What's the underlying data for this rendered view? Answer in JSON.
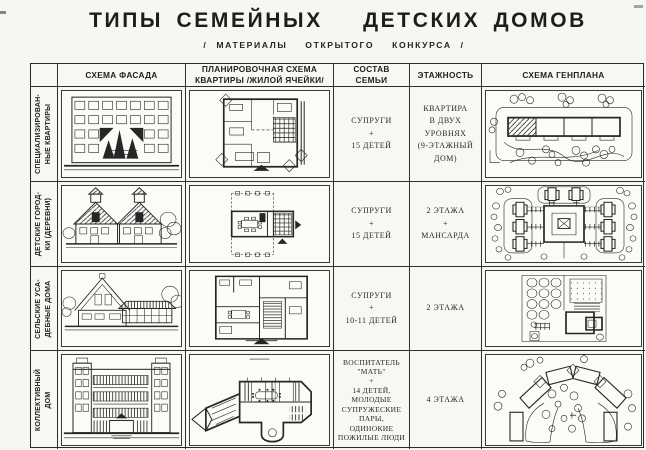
{
  "title": "ТИПЫ СЕМЕЙНЫХ   ДЕТСКИХ ДОМОВ",
  "subtitle": "/ МАТЕРИАЛЫ  ОТКРЫТОГО  КОНКУРСА /",
  "table": {
    "headers": {
      "facade": "СХЕМА ФАСАДА",
      "plan": "ПЛАНИРОВОЧНАЯ СХЕМА\nКВАРТИРЫ /ЖИЛОЙ ЯЧЕЙКИ/",
      "family": "СОСТАВ\nСЕМЬИ",
      "floors": "ЭТАЖНОСТЬ",
      "genplan": "СХЕМА  ГЕНПЛАНА"
    },
    "rows": [
      {
        "label": "СПЕЦИАЛИЗИРОВАН-\nНЫЕ КВАРТИРЫ",
        "family": "СУПРУГИ\n+\n15 ДЕТЕЙ",
        "floors": "КВАРТИРА\nВ ДВУХ\nУРОВНЯХ\n(9-ЭТАЖНЫЙ\nДОМ)"
      },
      {
        "label": "ДЕТСКИЕ ГОРОД-\nКИ (ДЕРЕВНИ)",
        "family": "СУПРУГИ\n+\n15 ДЕТЕЙ",
        "floors": "2 ЭТАЖА\n+\nМАНСАРДА"
      },
      {
        "label": "СЕЛЬСКИЕ УСА-\nДЕБНЫЕ ДОМА",
        "family": "СУПРУГИ\n+\n10-11 ДЕТЕЙ",
        "floors": "2 ЭТАЖА"
      },
      {
        "label": "КОЛЛЕКТИВНЫЙ\nДОМ",
        "family": "ВОСПИТАТЕЛЬ\n\"МАТЬ\"\n+\n14 ДЕТЕЙ,\nМОЛОДЫЕ\nСУПРУЖЕСКИЕ\nПАРЫ,\nОДИНОКИЕ\nПОЖИЛЫЕ ЛЮДИ",
        "floors": "4 ЭТАЖА"
      }
    ]
  },
  "ink_color": "#262626",
  "paper_color": "#f7f6f2"
}
